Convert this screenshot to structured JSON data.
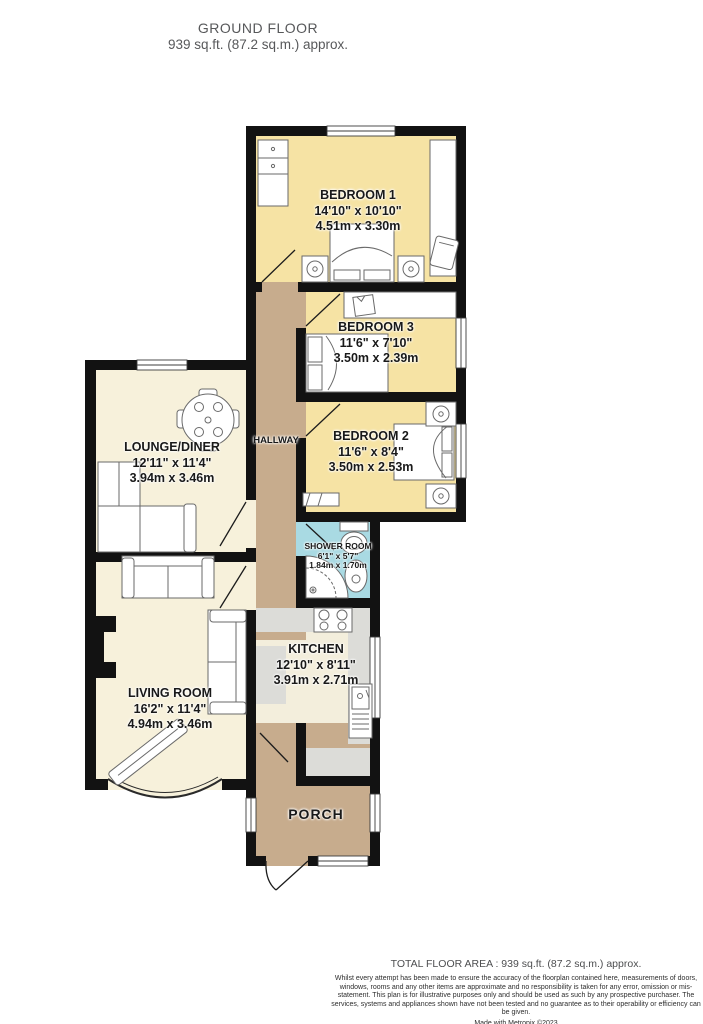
{
  "header": {
    "title": "GROUND FLOOR",
    "subtitle": "939 sq.ft. (87.2 sq.m.) approx."
  },
  "rooms": {
    "bedroom1": {
      "name": "BEDROOM 1",
      "imperial": "14'10\" x 10'10\"",
      "metric": "4.51m x 3.30m"
    },
    "bedroom3": {
      "name": "BEDROOM 3",
      "imperial": "11'6\" x 7'10\"",
      "metric": "3.50m x 2.39m"
    },
    "bedroom2": {
      "name": "BEDROOM 2",
      "imperial": "11'6\" x 8'4\"",
      "metric": "3.50m x 2.53m"
    },
    "shower": {
      "name": "SHOWER ROOM",
      "imperial": "6'1\" x 5'7\"",
      "metric": "1.84m x 1.70m"
    },
    "kitchen": {
      "name": "KITCHEN",
      "imperial": "12'10\" x 8'11\"",
      "metric": "3.91m x 2.71m"
    },
    "lounge": {
      "name": "LOUNGE/DINER",
      "imperial": "12'11\" x 11'4\"",
      "metric": "3.94m x 3.46m"
    },
    "living": {
      "name": "LIVING ROOM",
      "imperial": "16'2\" x 11'4\"",
      "metric": "4.94m x 3.46m"
    },
    "hallway": {
      "name": "HALLWAY"
    },
    "porch": {
      "name": "PORCH"
    }
  },
  "footer": {
    "total": "TOTAL FLOOR AREA : 939 sq.ft. (87.2 sq.m.) approx.",
    "disclaimer": "Whilst every attempt has been made to ensure the accuracy of the floorplan contained here, measurements of doors, windows, rooms and any other items are approximate and no responsibility is taken for any error, omission or mis-statement. This plan is for illustrative purposes only and should be used as such by any prospective purchaser. The services, systems and appliances shown have not been tested and no guarantee as to their operability or efficiency can be given.",
    "credit": "Made with Metropix ©2023"
  },
  "colors": {
    "bedroom": "#F6E3A4",
    "living": "#F7F1DB",
    "hall": "#C7AC8D",
    "shower": "#A9DAE3",
    "kitchen": "#F3EEDC",
    "counter": "#DCDCD8",
    "wall": "#121212"
  }
}
